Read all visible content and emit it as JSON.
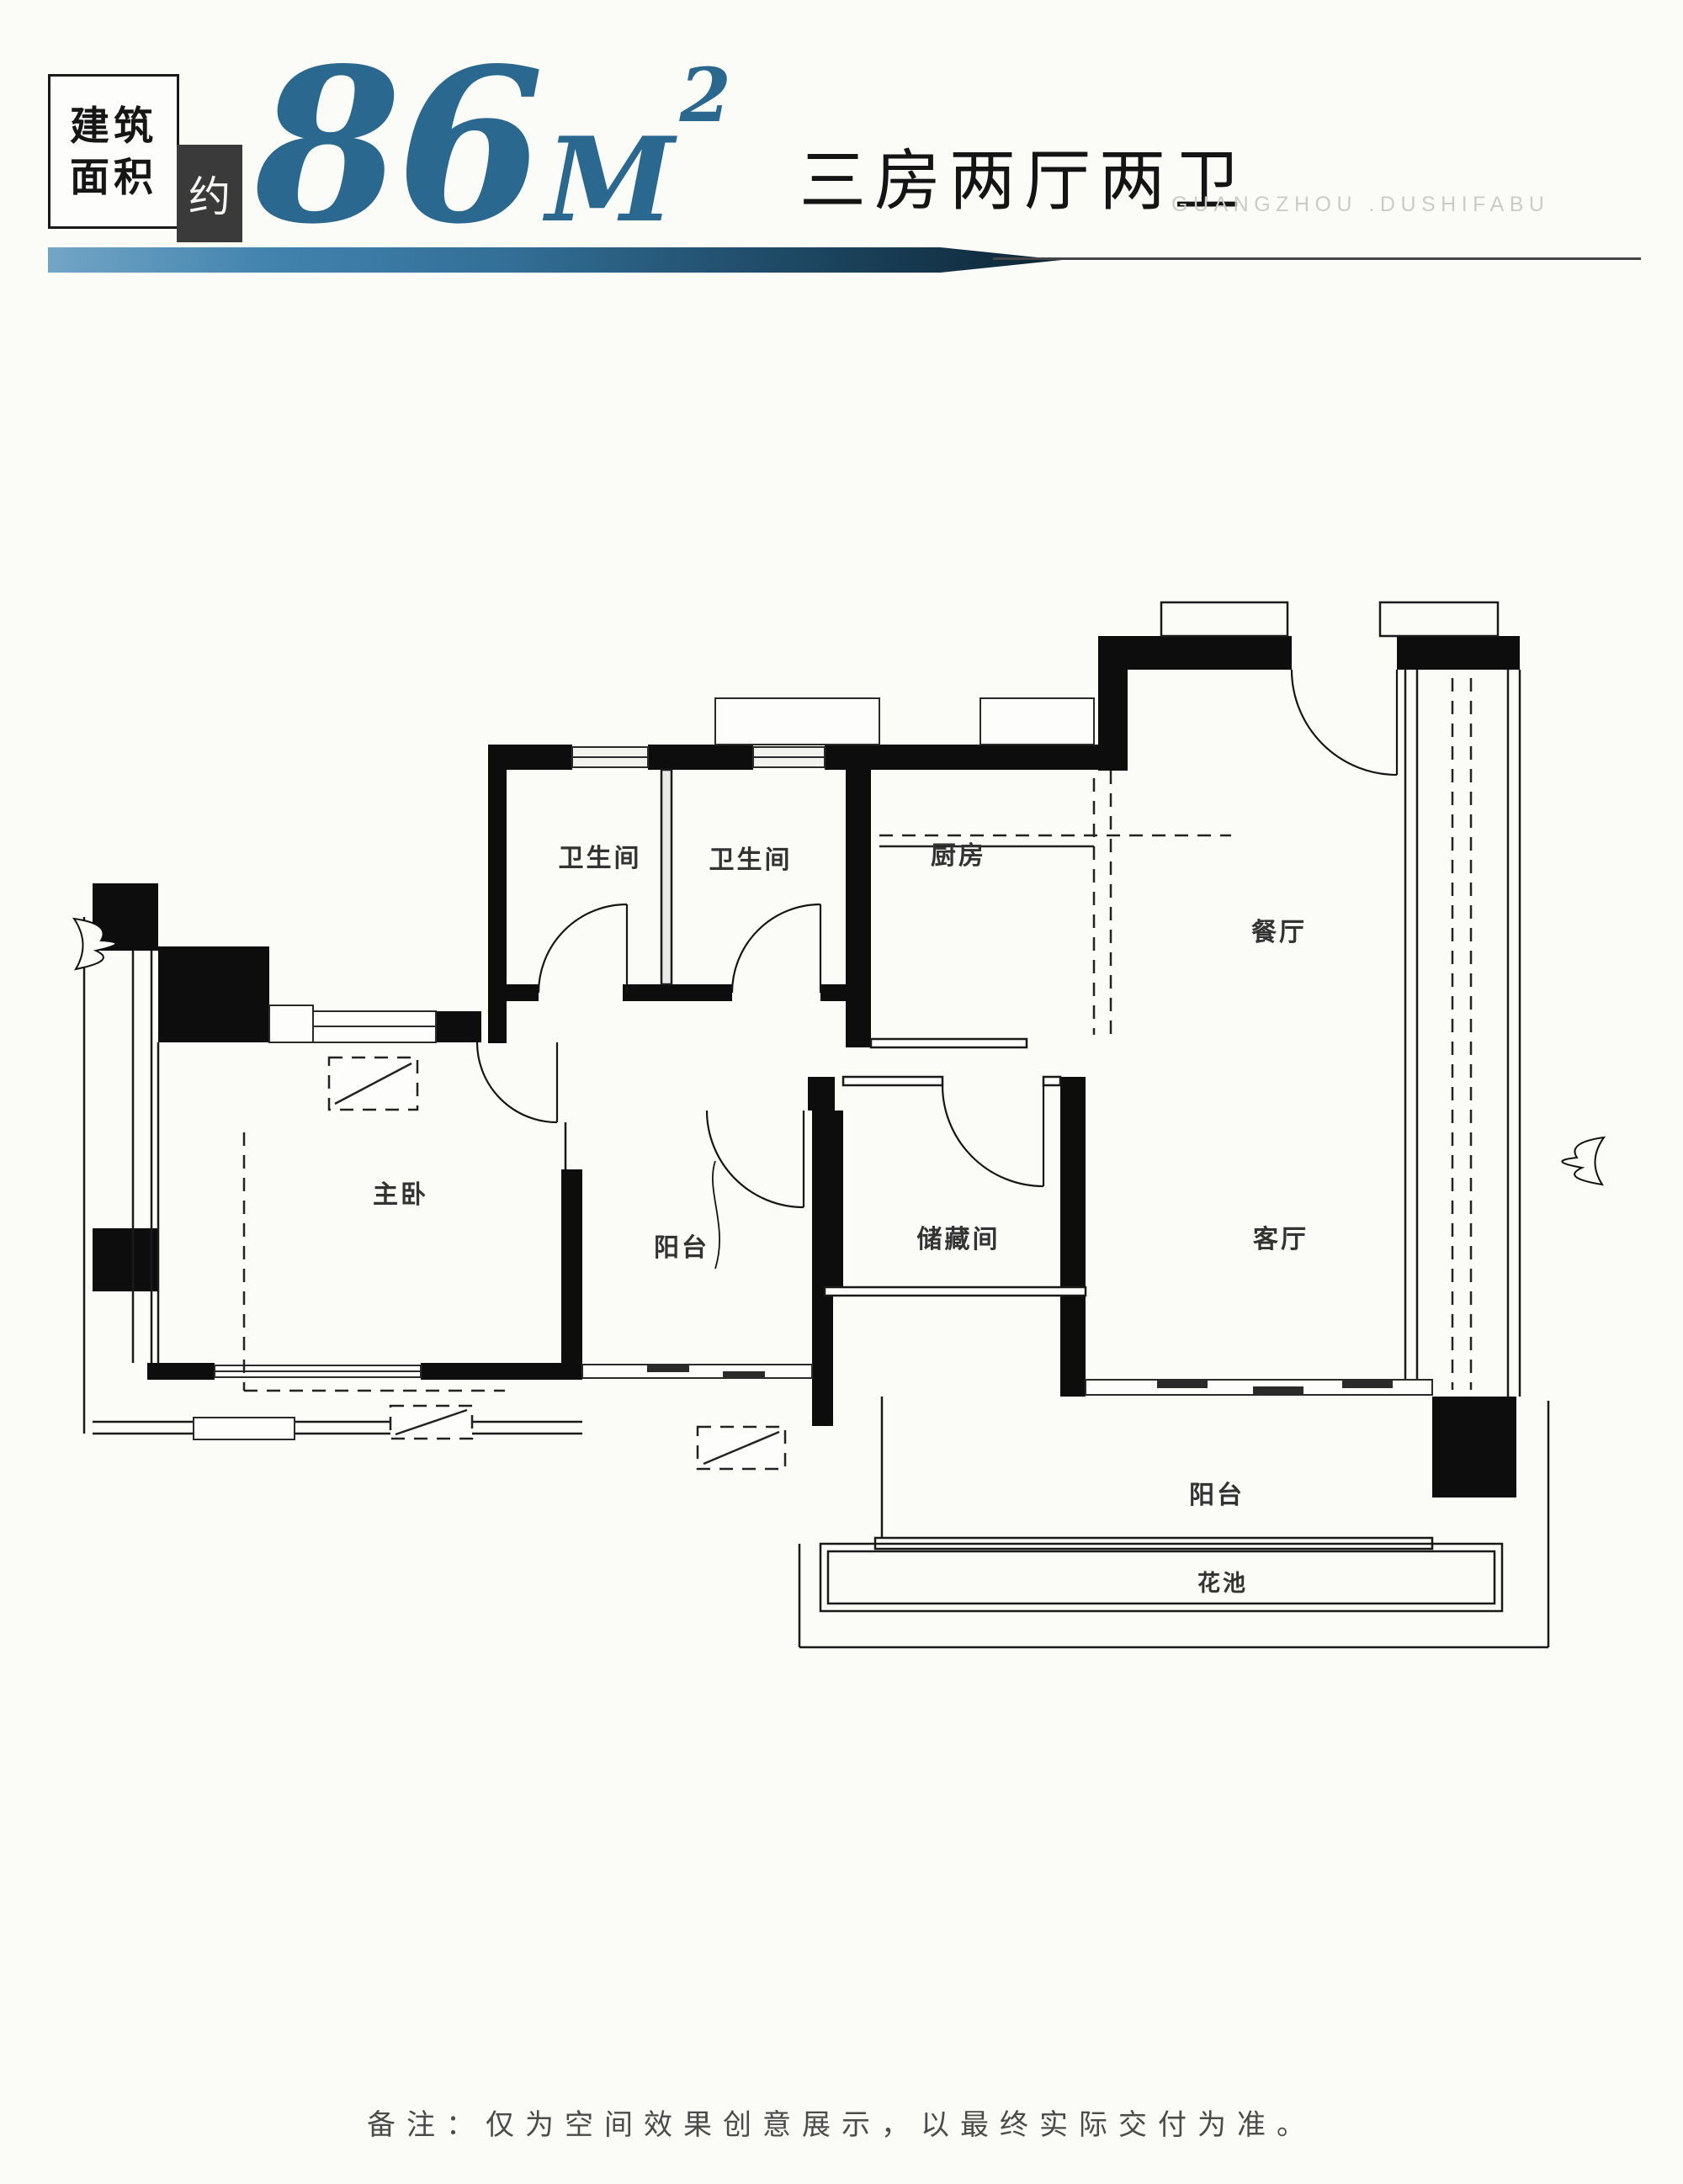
{
  "header": {
    "area_box_line1": "建筑",
    "area_box_line2": "面积",
    "approx_label": "约",
    "area_value": "86",
    "area_unit": "M",
    "area_exponent": "2",
    "layout_label": "三房两厅两卫",
    "watermark": "GUANGZHOU .DUSHIFABU",
    "accent_color": "#2a6890"
  },
  "plan": {
    "rooms": [
      {
        "name": "bathroom-1",
        "label": "卫生间"
      },
      {
        "name": "bathroom-2",
        "label": "卫生间"
      },
      {
        "name": "kitchen",
        "label": "厨房"
      },
      {
        "name": "dining-room",
        "label": "餐厅"
      },
      {
        "name": "master-bedroom",
        "label": "主卧"
      },
      {
        "name": "balcony-left",
        "label": "阳台"
      },
      {
        "name": "storage-room",
        "label": "储藏间"
      },
      {
        "name": "living-room",
        "label": "客厅"
      },
      {
        "name": "balcony-bottom",
        "label": "阳台"
      },
      {
        "name": "planter",
        "label": "花池"
      }
    ]
  },
  "footer": {
    "note": "备注：仅为空间效果创意展示，以最终实际交付为准。"
  }
}
